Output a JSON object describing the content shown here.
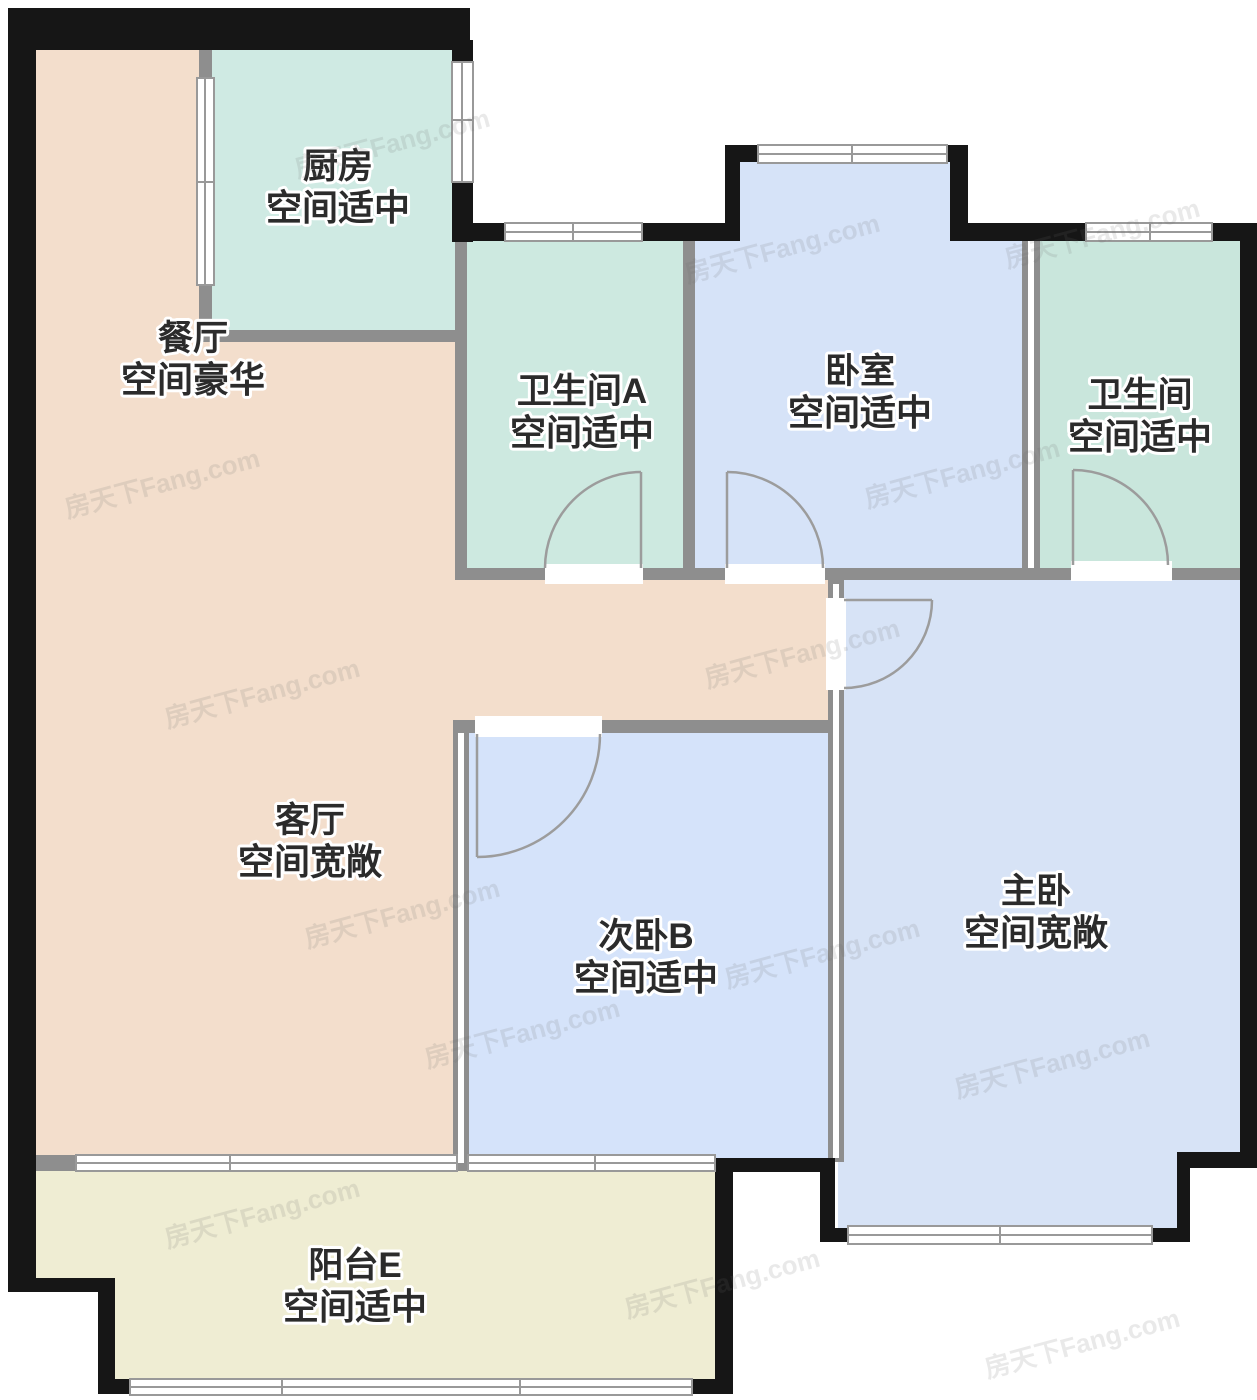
{
  "palette": {
    "background": "#ffffff",
    "wall_exterior": "#161616",
    "wall_interior": "#8e8e8e",
    "window_stroke": "#999999",
    "door_stroke": "#9c9c9c",
    "label_text": "#2b2b2b",
    "label_halo": "#ffffff"
  },
  "rooms": {
    "dining": {
      "name": "餐厅",
      "quality": "空间豪华"
    },
    "living": {
      "name": "客厅",
      "quality": "空间宽敞",
      "color": "#F3DECC"
    },
    "kitchen": {
      "name": "厨房",
      "quality": "空间适中",
      "color": "#CFEAE3"
    },
    "bathroom_a": {
      "name": "卫生间A",
      "quality": "空间适中",
      "color": "#CDE9E0"
    },
    "bedroom": {
      "name": "卧室",
      "quality": "空间适中",
      "color": "#D6E3F8"
    },
    "bathroom": {
      "name": "卫生间",
      "quality": "空间适中",
      "color": "#C9E6DC"
    },
    "secondary_bedroom": {
      "name": "次卧B",
      "quality": "空间适中",
      "color": "#D5E3FA"
    },
    "master_bedroom": {
      "name": "主卧",
      "quality": "空间宽敞",
      "color": "#D7E3F6"
    },
    "balcony": {
      "name": "阳台E",
      "quality": "空间适中",
      "color": "#EFEDD3"
    }
  },
  "watermarks": {
    "text": "房天下Fang.com",
    "positions": [
      [
        290,
        150
      ],
      [
        680,
        255
      ],
      [
        60,
        490
      ],
      [
        700,
        660
      ],
      [
        860,
        480
      ],
      [
        160,
        700
      ],
      [
        300,
        920
      ],
      [
        720,
        960
      ],
      [
        950,
        1070
      ],
      [
        160,
        1220
      ],
      [
        620,
        1290
      ],
      [
        980,
        1350
      ],
      [
        420,
        1040
      ],
      [
        1000,
        240
      ]
    ]
  }
}
